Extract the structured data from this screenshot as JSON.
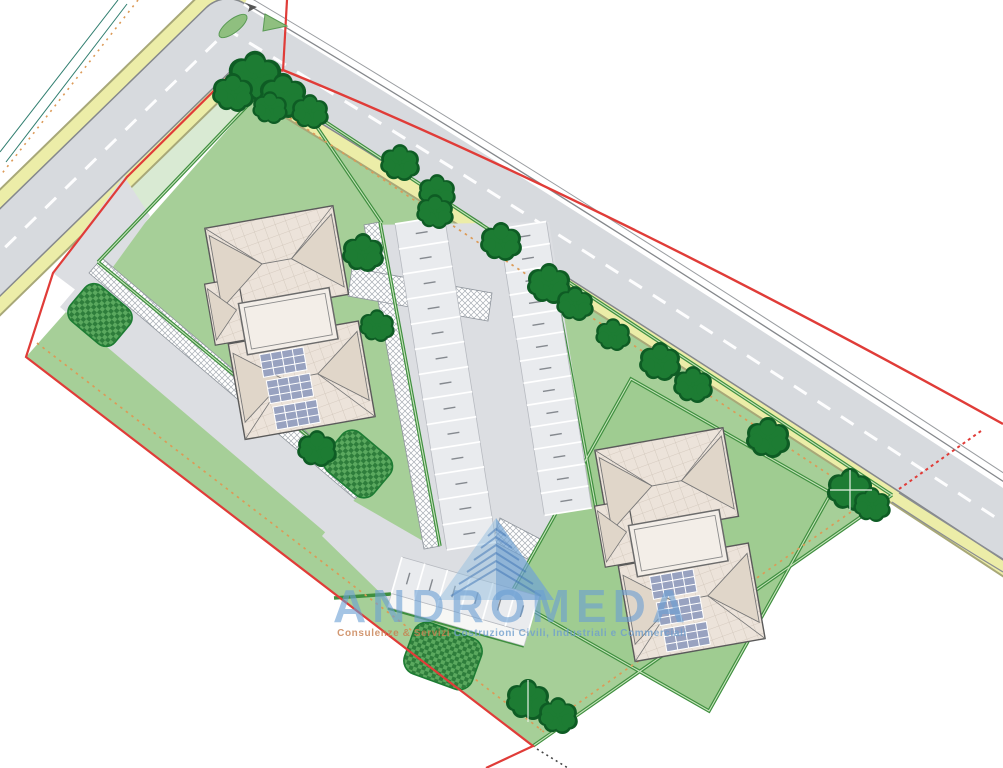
{
  "meta": {
    "title": "Planimetria generale - residential site plan"
  },
  "watermark": {
    "brand": "ANDROMEDA",
    "tagline_part1": "Consulenze & Servizi",
    "tagline_part2": " Costruzioni Civili, Industriali e Commerciali",
    "logo": "stepped-pyramid",
    "brand_color": "#6b9fd4",
    "tagline_color1": "#c87f4f",
    "tagline_color2": "#6f9fce"
  },
  "site": {
    "buildings": [
      {
        "id": "building-1",
        "roof": "hip tiled roof",
        "solar_panel_groups": 3,
        "courtyards": 1
      },
      {
        "id": "building-2",
        "roof": "hip tiled roof",
        "solar_panel_groups": 3,
        "courtyards": 1
      }
    ],
    "parking_rows": [
      {
        "id": "row-west",
        "stalls": 13
      },
      {
        "id": "row-east",
        "stalls": 13
      },
      {
        "id": "row-south",
        "stalls": 6
      }
    ],
    "stall_label_note": "illegible tiny rotated stall labels",
    "trees": 22,
    "shrub_patches": 3,
    "colors": {
      "lawn": "#a6cf98",
      "garden": "#9fcc91",
      "verge": "#d9ead3",
      "road": "#d7dade",
      "road_edge": "#85888c",
      "curb_yellow": "#eceda8",
      "curb_yellow_edge": "#a8a878",
      "hedge": "#3f8f3f",
      "hedge_light": "#c8e4bc",
      "roof": "#ece3da",
      "roof_shade": "#e0d6c9",
      "solar": "#98a2c0",
      "boundary_red": "#e03c38",
      "setback_orange": "#dc9a57",
      "tree": "#1d7c33",
      "tree_edge": "#0e5c24",
      "stall_fill": "#e9ebee",
      "stall_line": "#ffffff",
      "driveway": "#dcdee2",
      "fence_teal": "#2e7d6e"
    }
  }
}
